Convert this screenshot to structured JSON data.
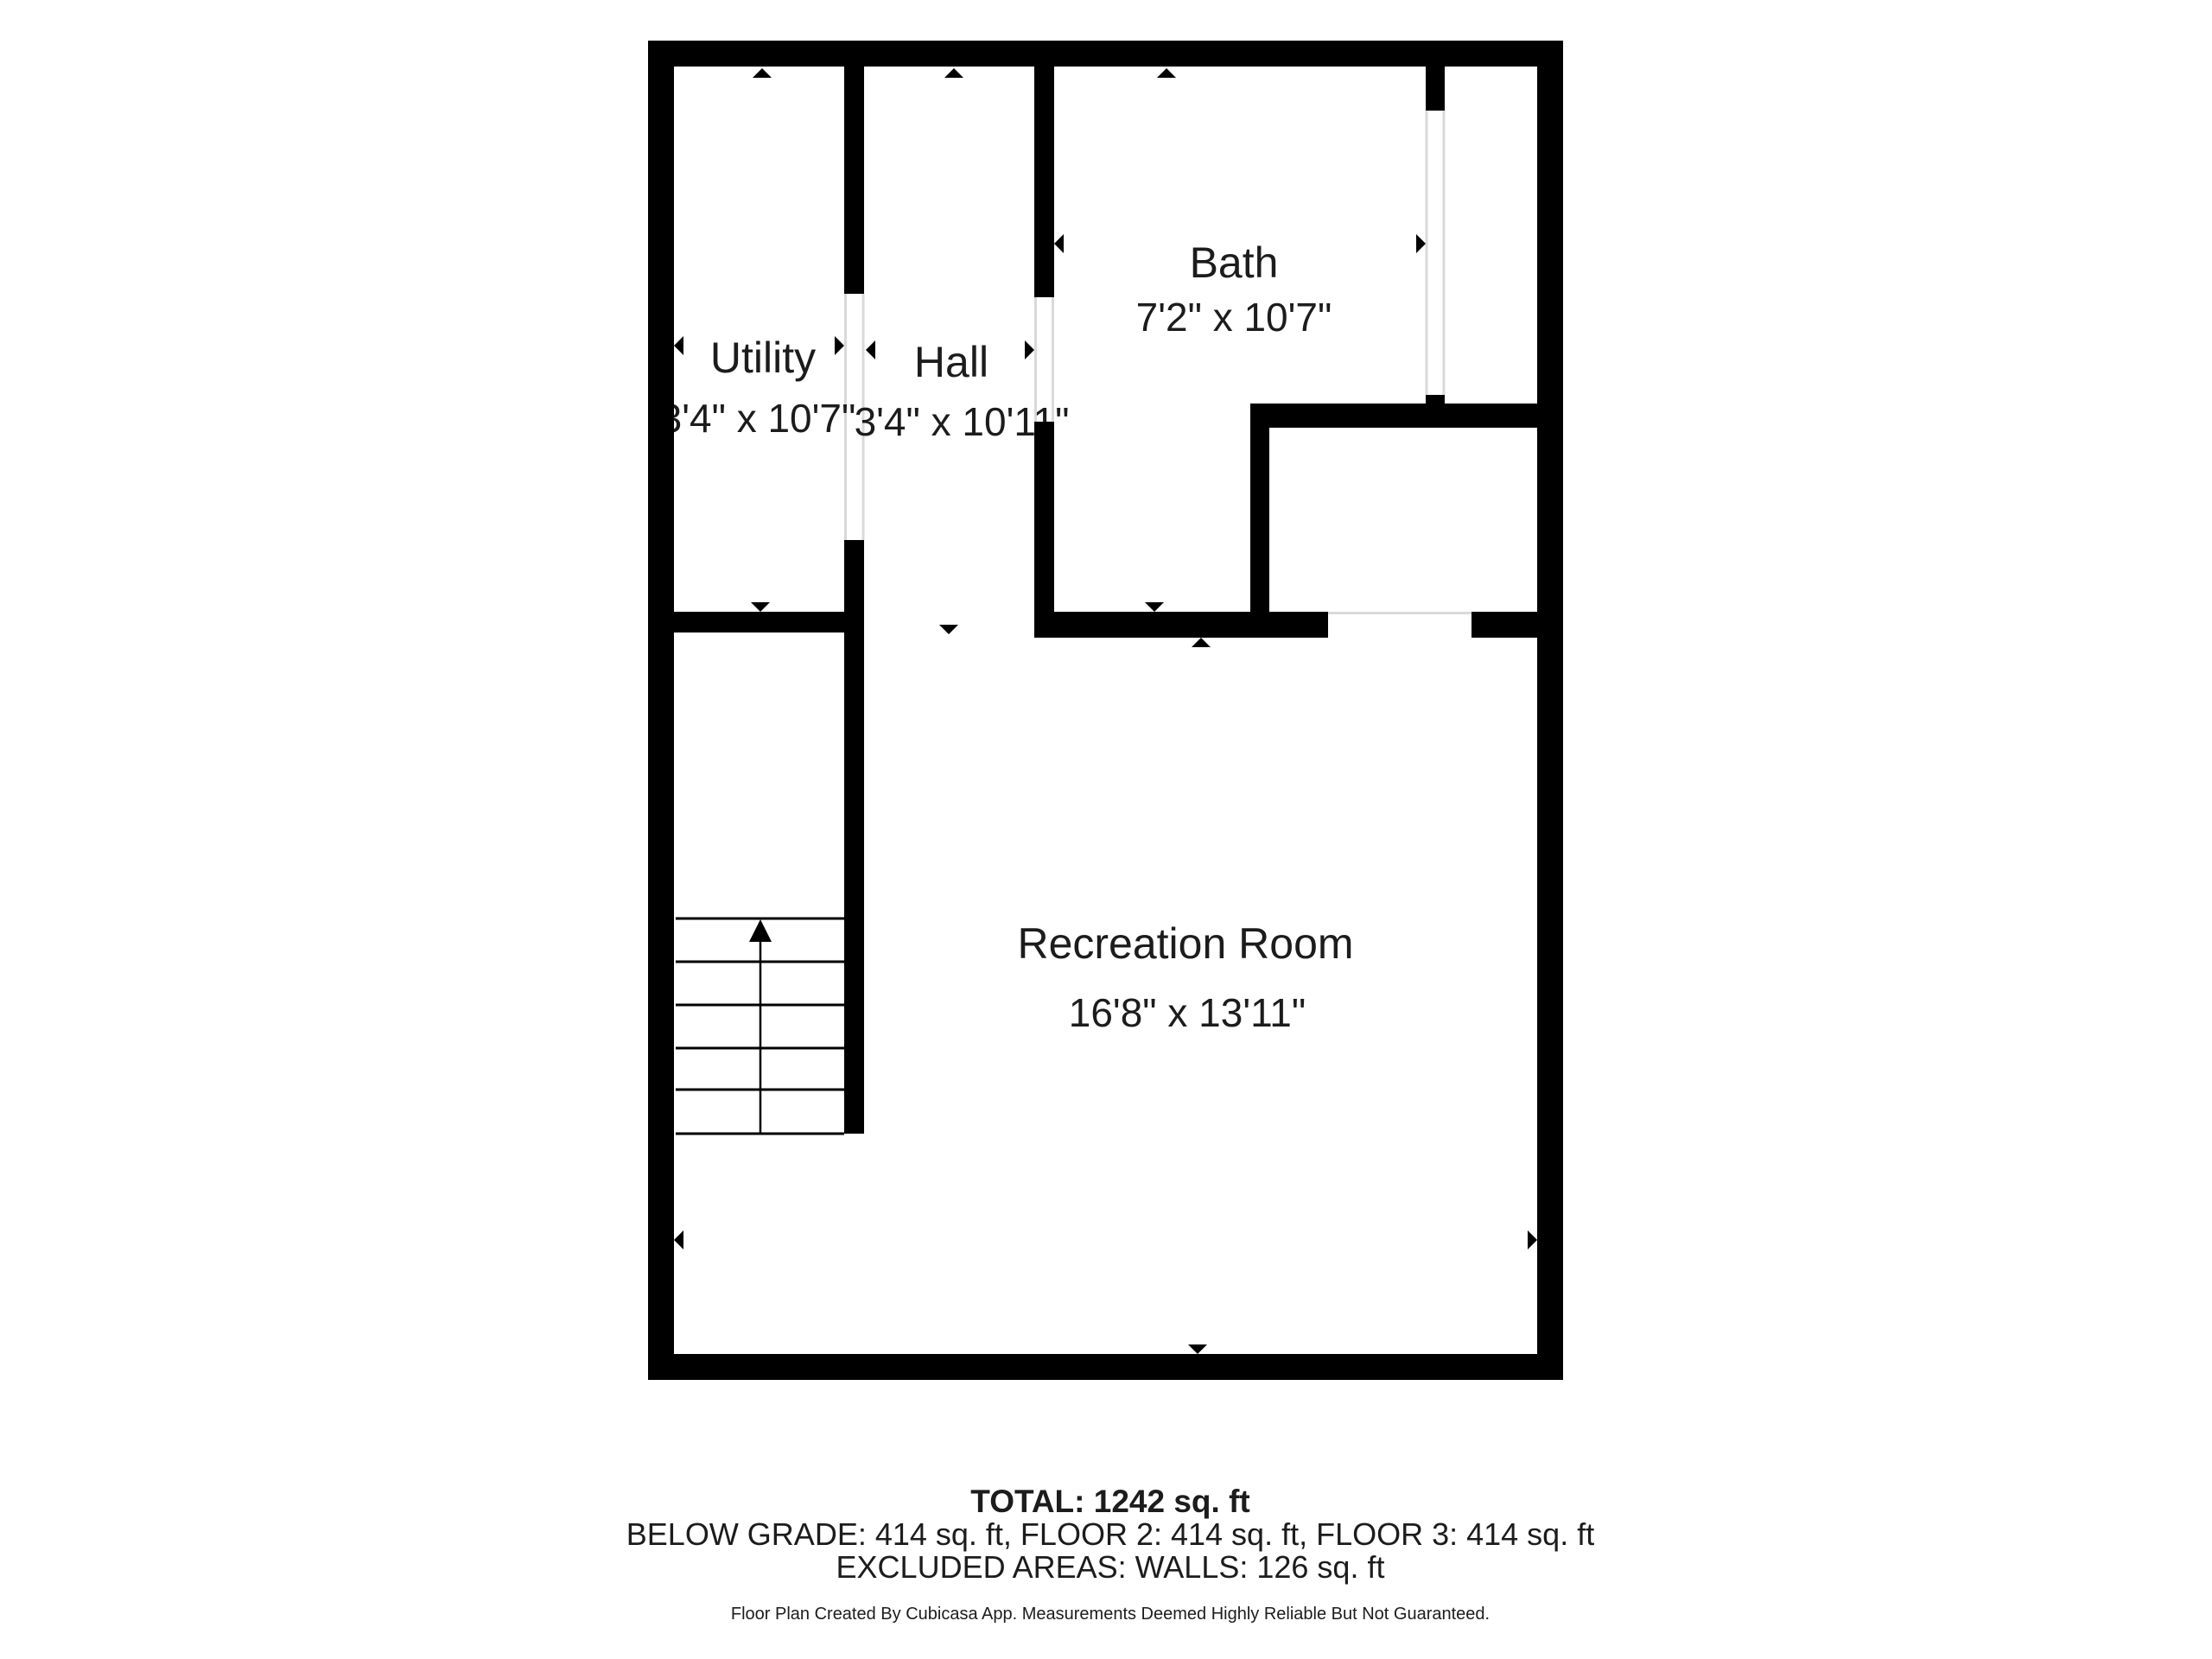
{
  "floorplan": {
    "rooms": [
      {
        "name": "Utility",
        "dimensions": "3'4\" x 10'7\""
      },
      {
        "name": "Hall",
        "dimensions": "3'4\" x 10'11\""
      },
      {
        "name": "Bath",
        "dimensions": "7'2\" x 10'7\""
      },
      {
        "name": "Recreation Room",
        "dimensions": "16'8\" x 13'11\""
      }
    ],
    "icons": {
      "stairs_direction": "up-arrow",
      "measurement_markers": "small black triangle arrows flanking each room's measured extents"
    }
  },
  "summary": {
    "total": "TOTAL: 1242 sq. ft",
    "floors": "BELOW GRADE: 414 sq. ft, FLOOR 2: 414 sq. ft, FLOOR 3: 414 sq. ft",
    "excluded": "EXCLUDED AREAS: WALLS: 126 sq. ft"
  },
  "footer": "Floor Plan Created By Cubicasa App. Measurements Deemed Highly Reliable But Not Guaranteed.",
  "colors": {
    "wall": "#000000",
    "text": "#1c1c1c",
    "detail_line": "#d9d9d9",
    "background": "#ffffff"
  }
}
